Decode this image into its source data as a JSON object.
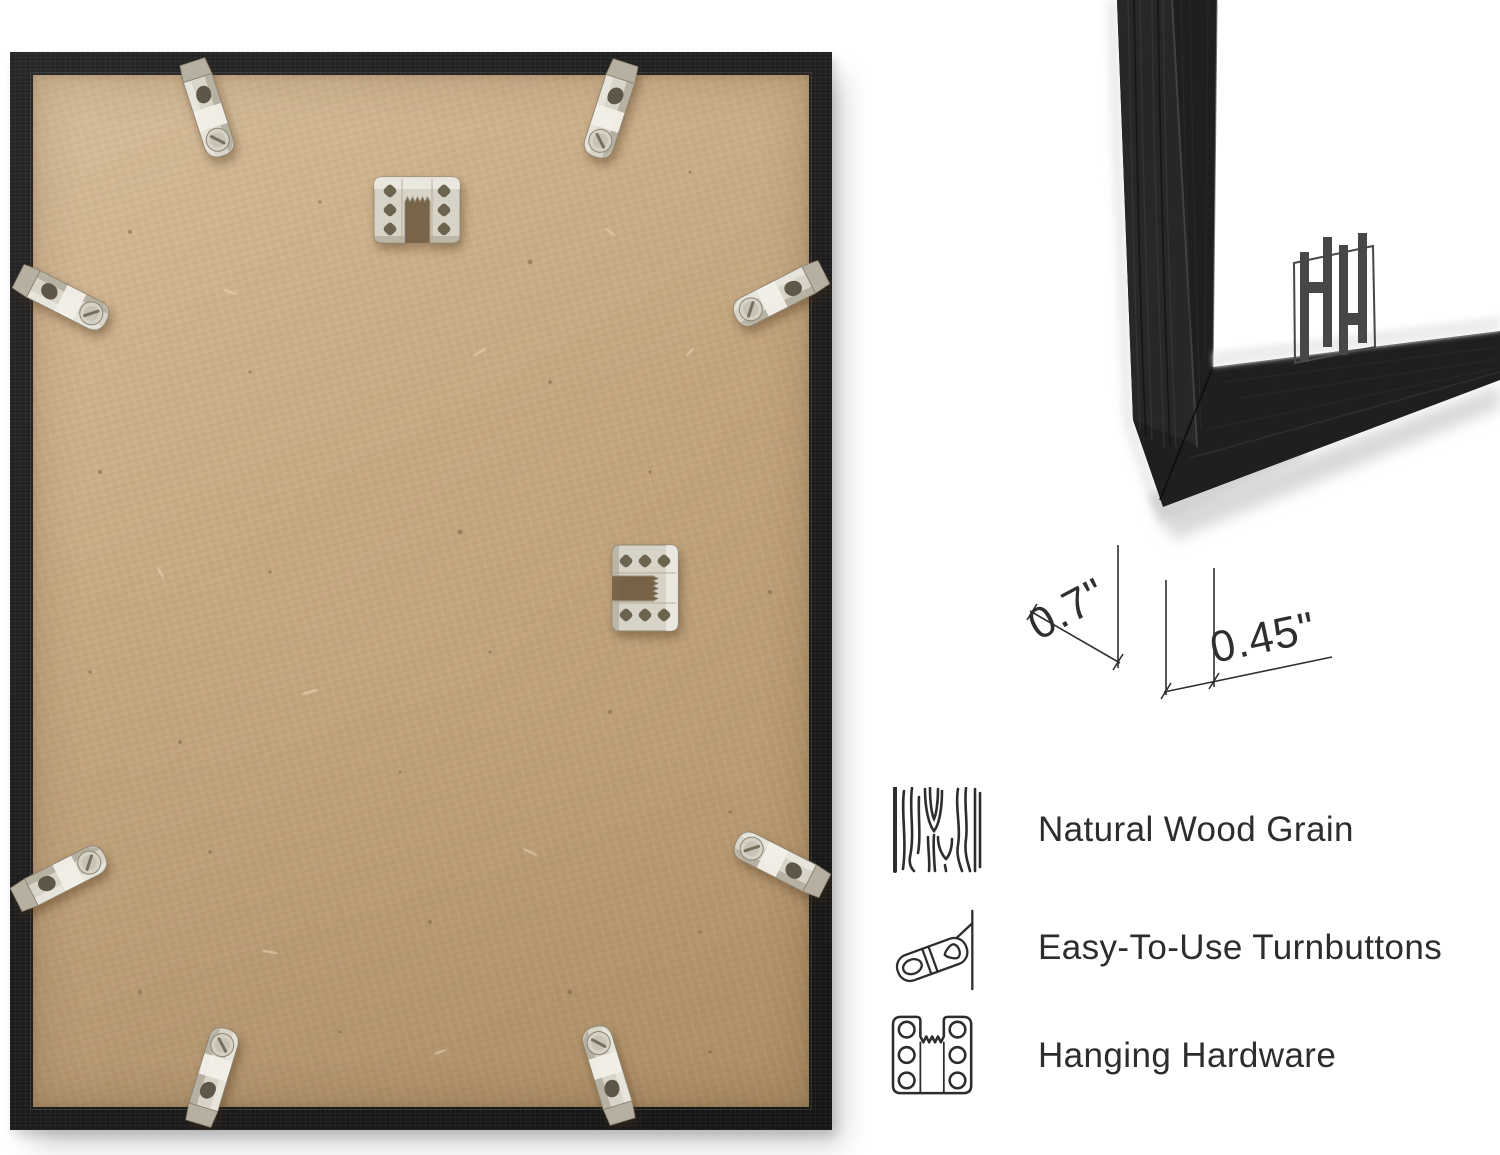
{
  "page": {
    "background_color": "#ffffff"
  },
  "back_photo": {
    "description": "back of black picture frame with MDF board",
    "frame_color": "#1f1f1f",
    "board_color": "#c4a67e",
    "metal_color": "#d8d4c8",
    "turnbutton_count": 8,
    "sawtooth_hanger_count": 2
  },
  "corner_photo": {
    "description": "front corner close-up of black frame with white mat",
    "frame_color": "#1f1f1f",
    "mat_color": "#ffffff",
    "logo_monogram": "HH",
    "measurements": {
      "depth": "0.7\"",
      "face_width": "0.45\""
    }
  },
  "features": {
    "text_color": "#2d2d2d",
    "items": [
      {
        "icon": "wood-grain-icon",
        "label": "Natural Wood Grain"
      },
      {
        "icon": "turnbutton-icon",
        "label": "Easy-To-Use Turnbuttons"
      },
      {
        "icon": "hanging-hardware-icon",
        "label": "Hanging Hardware"
      }
    ]
  }
}
